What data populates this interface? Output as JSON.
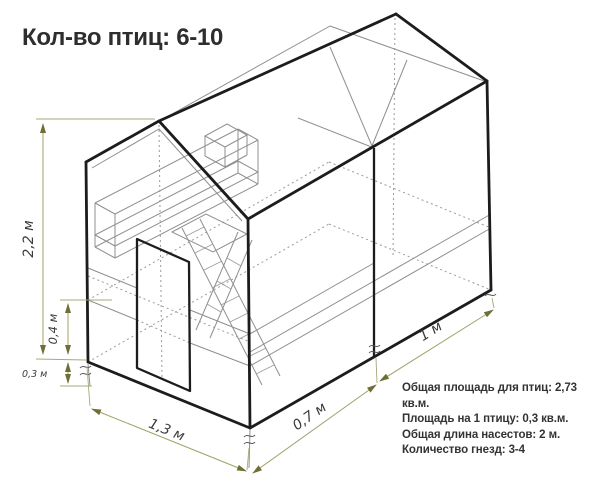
{
  "title": "Кол-во птиц: 6-10",
  "drawing": "isometric-chicken-coop-wireframe",
  "dimensions": {
    "total_height": "2,2 м",
    "nest_level_height": "0,4 м",
    "legs_height": "0,3 м",
    "front_width": "1,3 м",
    "front_section_depth": "0,7 м",
    "back_section_depth": "1 м"
  },
  "specs": {
    "line1": "Общая площадь для птиц: 2,73 кв.м.",
    "line2": "Площадь на 1 птицу: 0,3 кв.м.",
    "line3": "Общая длина насестов: 2 м.",
    "line4": "Количество гнезд: 3-4"
  },
  "colors": {
    "background": "#ffffff",
    "outline": "#1c1c1c",
    "interior_lines": "#8f8f8f",
    "dimension_lines": "#a0a068",
    "text": "#333333"
  }
}
